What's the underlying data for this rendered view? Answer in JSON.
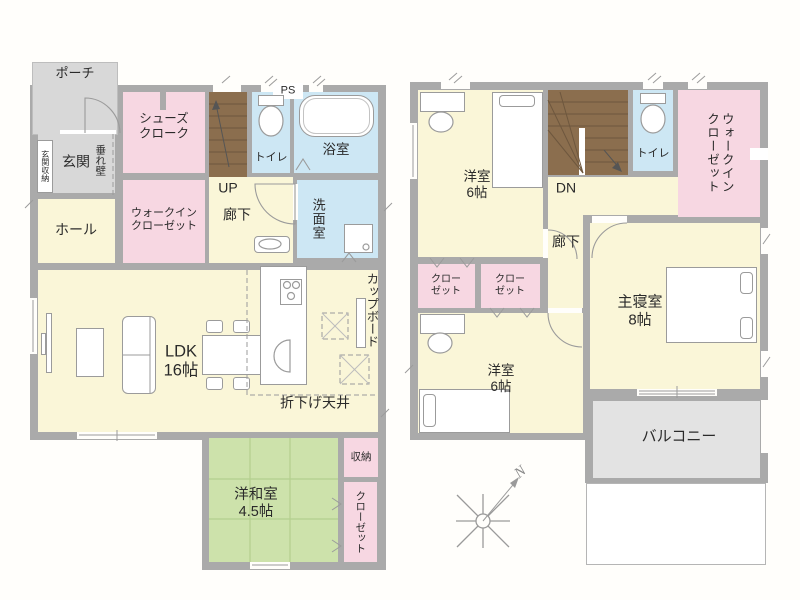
{
  "floor1": {
    "porch": "ポーチ",
    "genkan": "玄関",
    "genkan_storage": "玄関収納",
    "tarekabe": "垂れ壁",
    "shoes_cloak": "シューズ\nクローク",
    "hall": "ホール",
    "wic": "ウォークイン\nクローゼット",
    "up": "UP",
    "corridor": "廊下",
    "toilet": "トイレ",
    "ps": "PS",
    "bath": "浴室",
    "washroom": "洗面室",
    "cupboard": "カップボード",
    "ldk": "LDK\n16帖",
    "lowered_ceiling": "折下げ天井",
    "washitsu": "洋和室\n4.5帖",
    "storage": "収納",
    "closet": "クローゼット"
  },
  "floor2": {
    "bedroom_a": "洋室\n6帖",
    "dn": "DN",
    "toilet": "トイレ",
    "wic": "ウォークイン\nクローゼット",
    "corridor": "廊下",
    "closet_a": "クロー\nゼット",
    "closet_b": "クロー\nゼット",
    "master": "主寝室\n8帖",
    "bedroom_b": "洋室\n6帖",
    "balcony": "バルコニー"
  },
  "compass": {
    "north": "N"
  },
  "colors": {
    "wall": "#aaaaaa",
    "floor_cream": "#faf6d8",
    "room_pink": "#f7d7e2",
    "wet_blue": "#cde7f4",
    "tatami_green": "#cde2ab",
    "stairs_brown": "#8b6e4e",
    "porch_gray": "#d8d8d8",
    "balcony_gray": "#e3e3e3",
    "linework": "#9b9b9b"
  }
}
